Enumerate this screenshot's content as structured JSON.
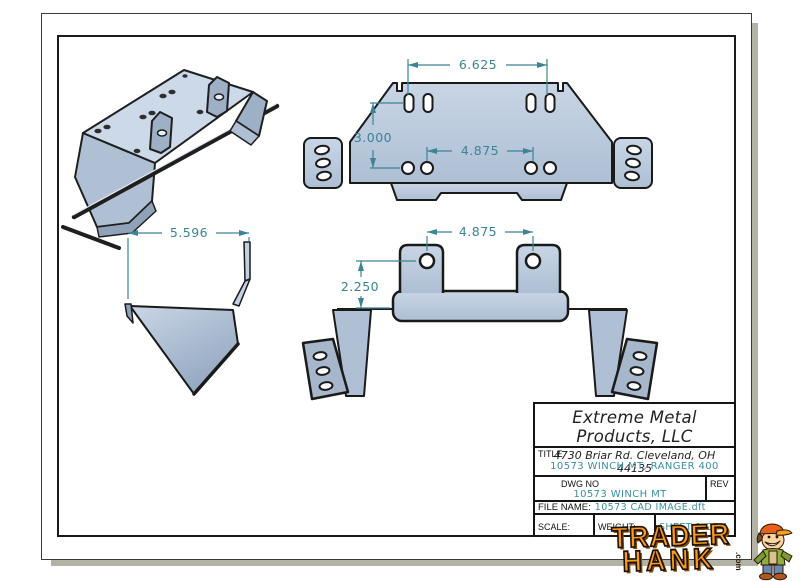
{
  "title_block": {
    "company": "Extreme Metal Products, LLC",
    "address": "4730 Briar Rd. Cleveland, OH 44135",
    "title_label": "TITLE",
    "title_value": "10573 WINCH MT, RANGER 400",
    "dwg_no_label": "DWG NO",
    "dwg_no_value": "10573 WINCH MT",
    "rev_label": "REV",
    "file_name_label": "FILE NAME:",
    "file_name_value": "10573 CAD IMAGE.dft",
    "scale_label": "SCALE:",
    "weight_label": "WEIGHT:",
    "sheet_label": "SHEET 1 OF 1"
  },
  "dimensions": {
    "plate_top_width": "6.625",
    "plate_hole_height": "3.000",
    "plate_bottom_width": "4.875",
    "bracket_tab_spacing": "4.875",
    "bracket_tab_height": "2.250",
    "side_view_width": "5.596"
  },
  "logo": {
    "line1": "TRADER",
    "line2": "HANK",
    "suffix": ".com"
  },
  "colors": {
    "dimension_teal": "#3a8494",
    "value_teal": "#3a8f9e",
    "part_fill_light": "#c6d3e4",
    "part_fill": "#bccadd",
    "part_fill_dark": "#a3b4c9",
    "outline": "#1a1a1a",
    "logo_orange": "#f89b1e",
    "sheet_shadow": "#b3b3a5"
  }
}
